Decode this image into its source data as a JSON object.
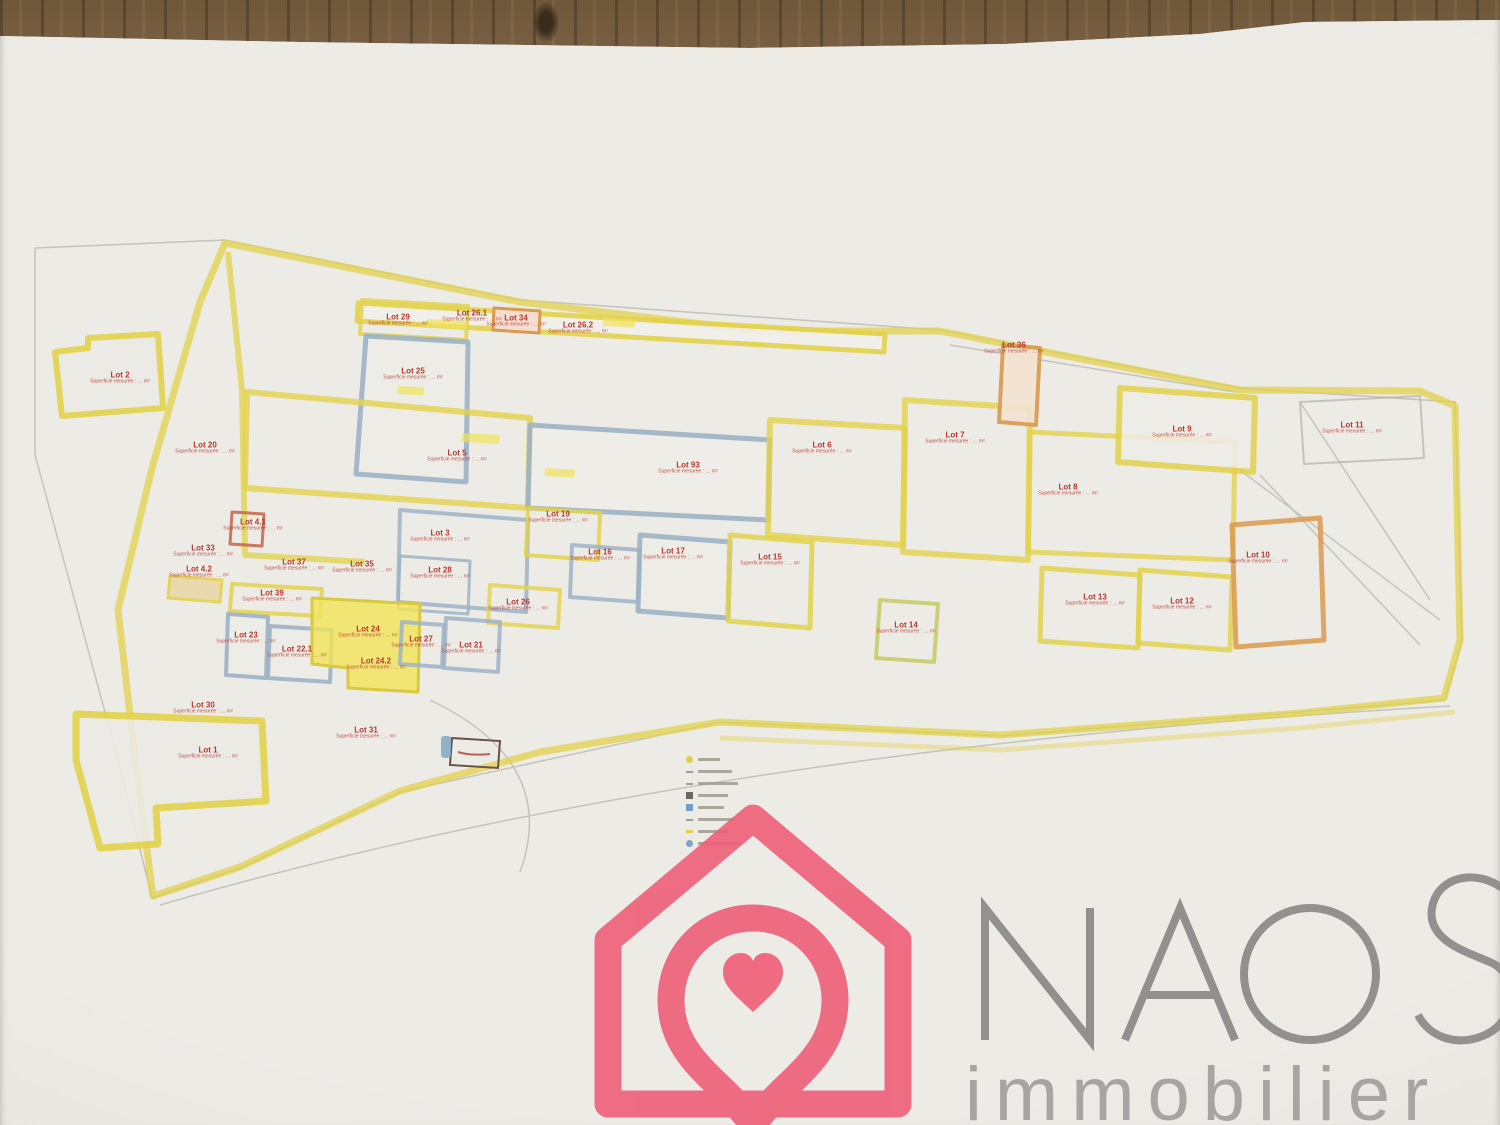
{
  "watermark": {
    "brand": "NAOS",
    "tagline": "immobilier",
    "brand_pink": "#ee5f78",
    "brand_gray": "#8c8c8a",
    "tagline_gray": "#a5a5a3"
  },
  "palette": {
    "boundary_yellow": "#e2d24b",
    "parcel_blue": "#9db3c6",
    "parcel_orange": "#d99a4e",
    "parcel_olive": "#c9cc6a",
    "lot_label_red": "#b23a32",
    "highlight_yellow": "#f0e45a",
    "selected_lot_fill": "#f1e557",
    "paper": "#e9e7e2"
  },
  "plan": {
    "sub_line": "Superficie mesurée : … m²",
    "lots": [
      {
        "label": "Lot 2",
        "x": 120,
        "y": 378
      },
      {
        "label": "Lot 20",
        "x": 205,
        "y": 448
      },
      {
        "label": "Lot 29",
        "x": 398,
        "y": 320
      },
      {
        "label": "Lot 25",
        "x": 413,
        "y": 374
      },
      {
        "label": "Lot 26.1",
        "x": 472,
        "y": 316
      },
      {
        "label": "Lot 34",
        "x": 516,
        "y": 321
      },
      {
        "label": "Lot 26.2",
        "x": 578,
        "y": 328
      },
      {
        "label": "Lot 5",
        "x": 457,
        "y": 456
      },
      {
        "label": "Lot 93",
        "x": 688,
        "y": 468
      },
      {
        "label": "Lot 6",
        "x": 822,
        "y": 448
      },
      {
        "label": "Lot 7",
        "x": 955,
        "y": 438
      },
      {
        "label": "Lot 36",
        "x": 1014,
        "y": 348
      },
      {
        "label": "Lot 9",
        "x": 1182,
        "y": 432
      },
      {
        "label": "Lot 8",
        "x": 1068,
        "y": 490
      },
      {
        "label": "Lot 11",
        "x": 1352,
        "y": 428
      },
      {
        "label": "Lot 4.1",
        "x": 253,
        "y": 525
      },
      {
        "label": "Lot 33",
        "x": 203,
        "y": 551
      },
      {
        "label": "Lot 4.2",
        "x": 199,
        "y": 572
      },
      {
        "label": "Lot 37",
        "x": 294,
        "y": 565
      },
      {
        "label": "Lot 35",
        "x": 362,
        "y": 567
      },
      {
        "label": "Lot 3",
        "x": 440,
        "y": 536
      },
      {
        "label": "Lot 28",
        "x": 440,
        "y": 573
      },
      {
        "label": "Lot 19",
        "x": 558,
        "y": 517
      },
      {
        "label": "Lot 16",
        "x": 600,
        "y": 555
      },
      {
        "label": "Lot 17",
        "x": 673,
        "y": 554
      },
      {
        "label": "Lot 15",
        "x": 770,
        "y": 560
      },
      {
        "label": "Lot 26",
        "x": 518,
        "y": 605
      },
      {
        "label": "Lot 39",
        "x": 272,
        "y": 596
      },
      {
        "label": "Lot 23",
        "x": 246,
        "y": 638
      },
      {
        "label": "Lot 22.1",
        "x": 297,
        "y": 652
      },
      {
        "label": "Lot 24",
        "x": 368,
        "y": 632
      },
      {
        "label": "Lot 24.2",
        "x": 376,
        "y": 664
      },
      {
        "label": "Lot 27",
        "x": 421,
        "y": 642
      },
      {
        "label": "Lot 21",
        "x": 471,
        "y": 648
      },
      {
        "label": "Lot 14",
        "x": 906,
        "y": 628
      },
      {
        "label": "Lot 13",
        "x": 1095,
        "y": 600
      },
      {
        "label": "Lot 12",
        "x": 1182,
        "y": 604
      },
      {
        "label": "Lot 10",
        "x": 1258,
        "y": 558
      },
      {
        "label": "Lot 30",
        "x": 203,
        "y": 708
      },
      {
        "label": "Lot 1",
        "x": 208,
        "y": 753
      },
      {
        "label": "Lot 31",
        "x": 366,
        "y": 733
      }
    ]
  },
  "legend": {
    "items": [
      {
        "marker": "yellow-circle-marker",
        "w": 22
      },
      {
        "marker": "pencil-line",
        "w": 34
      },
      {
        "marker": "pencil-line",
        "w": 40
      },
      {
        "marker": "dark-square-marker",
        "w": 30
      },
      {
        "marker": "blue-square-marker",
        "w": 26
      },
      {
        "marker": "pencil-line",
        "w": 36
      },
      {
        "marker": "yellow-line-marker",
        "w": 30
      },
      {
        "marker": "blue-circle-marker",
        "w": 42
      }
    ]
  }
}
